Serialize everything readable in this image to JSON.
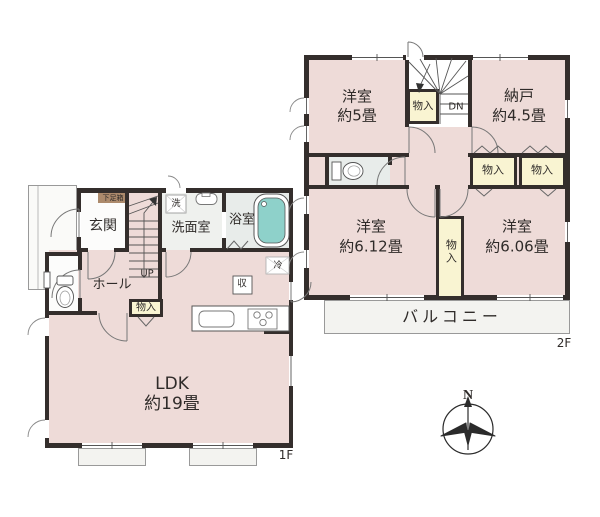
{
  "colors": {
    "wall": "#342e2c",
    "room": "#eedbd8",
    "closet": "#f9f4d2",
    "bath_tub": "#8ed1ca",
    "washroom": "#eff1ee",
    "bathroom": "#e8ecea",
    "white_room": "#fcfcfb",
    "shoe": "#ac8a6c",
    "balcony": "#f3f3f0",
    "porch": "#fafaf8"
  },
  "floor2": {
    "label": "2F",
    "rooms": {
      "yoshitsu5": {
        "name": "洋室",
        "size": "約5畳"
      },
      "nando": {
        "name": "納戸",
        "size": "約4.5畳"
      },
      "yoshitsu612": {
        "name": "洋室",
        "size": "約6.12畳"
      },
      "yoshitsu606": {
        "name": "洋室",
        "size": "約6.06畳"
      }
    },
    "closet": "物入",
    "stairs_down": "DN",
    "balcony": "バルコニー"
  },
  "floor1": {
    "label": "1F",
    "rooms": {
      "ldk": {
        "name": "LDK",
        "size": "約19畳"
      },
      "genkan": "玄関",
      "hall": "ホール",
      "senmenshitsu": "洗面室",
      "yokushitsu": "浴室"
    },
    "labels": {
      "getabako": "下足箱",
      "washer": "洗",
      "fridge": "冷",
      "storage": "収",
      "closet": "物入",
      "stairs_up": "UP"
    }
  },
  "compass": {
    "north": "N"
  }
}
